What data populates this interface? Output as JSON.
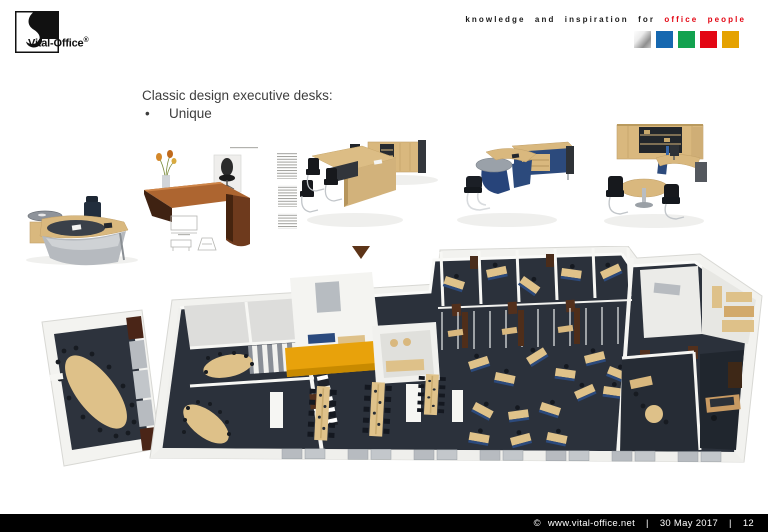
{
  "header": {
    "logo_text": "Vital-Office",
    "logo_registered": "®",
    "tagline": "knowledge and inspiration for",
    "tagline_accent": "office people",
    "squares": [
      {
        "name": "silver",
        "color": "#c8c8c8"
      },
      {
        "name": "blue",
        "color": "#1668b0"
      },
      {
        "name": "green",
        "color": "#13a24f"
      },
      {
        "name": "red",
        "color": "#e30613"
      },
      {
        "name": "amber",
        "color": "#e5a200"
      }
    ]
  },
  "slide": {
    "title": "Classic design executive desks:",
    "bullet_symbol": "•",
    "bullet": "Unique"
  },
  "figures": {
    "desk_photo": "executive desk photo",
    "product_sheet": "classic desk product sheet",
    "render_1": "desk with wall cabinet render",
    "render_2": "blue desk with sideboard render",
    "render_3": "cabinet wall office render",
    "floor_plan": "3D office floor plan render"
  },
  "footer": {
    "copyright": "©",
    "url": "www.vital-office.net",
    "separator": "|",
    "date": "30 May 2017",
    "page": "12"
  },
  "colors": {
    "accent_red": "#e30613",
    "carpet": "#2b313b",
    "wood": "#d9b87e",
    "navy": "#2c4a7c",
    "orange_wall": "#e8a20b"
  }
}
